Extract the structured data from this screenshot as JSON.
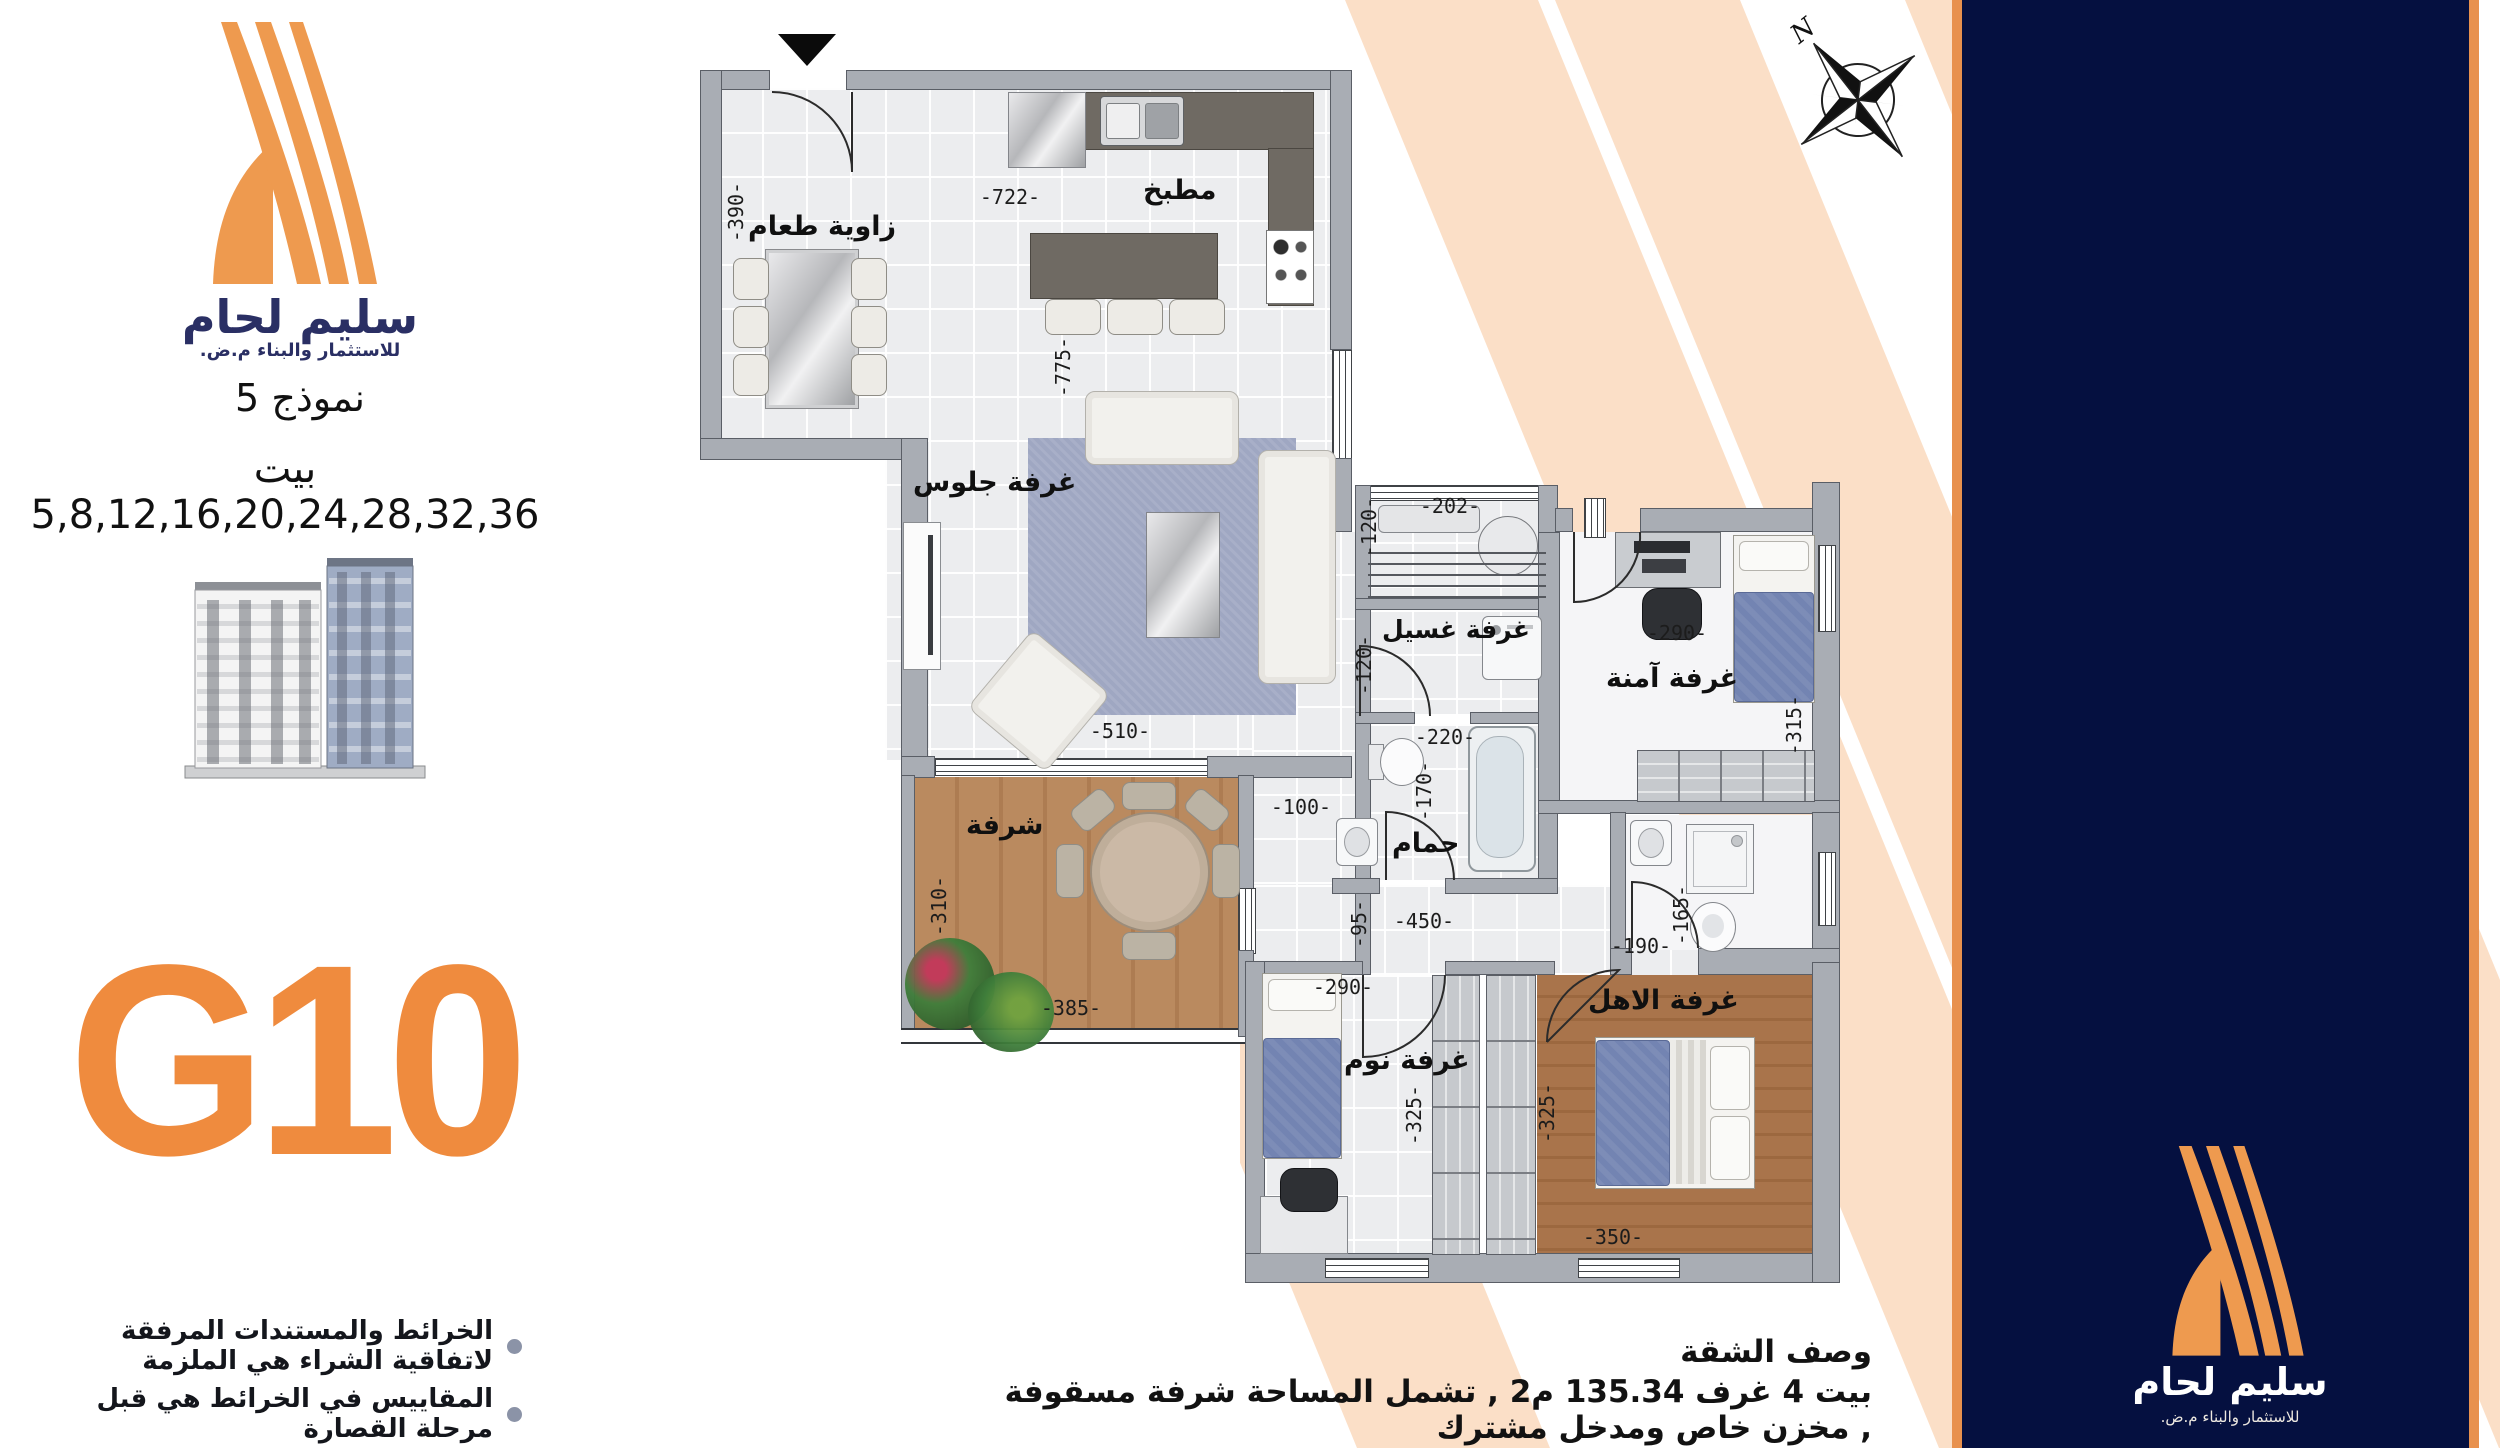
{
  "branding": {
    "title": "سليم لحام",
    "subtitle": "للاستثمار والبناء م.ض.",
    "model": "نموذج 5",
    "houses": "بيت 5,8,12,16,20,24,28,32,36",
    "unit": "G10"
  },
  "compass": {
    "north": "N"
  },
  "rooms": {
    "kitchen": "مطبخ",
    "dining": "زاوية طعام",
    "living": "غرفة جلوس",
    "balcony": "شرفة",
    "laundry": "غرفة غسيل",
    "bath": "حمام",
    "safe": "غرفة آمنة",
    "bedroom": "غرفة نوم",
    "master": "غرفة الاهل"
  },
  "dims": {
    "d390": "-390-",
    "d722": "-722-",
    "d775": "-775-",
    "d510": "-510-",
    "d100": "-100-",
    "d310": "-310-",
    "d385": "-385-",
    "d202": "-202-",
    "d120a": "-120-",
    "d120b": "-120-",
    "d220": "-220-",
    "d170": "-170-",
    "d290a": "-290-",
    "d315": "-315-",
    "d95": "-95-",
    "d450": "-450-",
    "d165": "-165-",
    "d190": "-190-",
    "d290b": "-290-",
    "d325a": "-325-",
    "d325b": "-325-",
    "d350": "-350-"
  },
  "notes": {
    "n1": "الخرائط والمستندات المرفقة لاتفاقية الشراء هي الملزمة",
    "n2": "المقاييس في الخرائط هي قبل مرحلة القصارة"
  },
  "description": {
    "heading": "وصف الشقة",
    "body": "بيت 4 غرف 135.34 م2 , تشمل المساحة شرفة مسقوفة , مخزن خاص ومدخل مشترك"
  },
  "colors": {
    "navy": "#051040",
    "orange_strip": "#E8914E",
    "logo_orange": "#EE9A4F",
    "unit_orange": "#EF8B3E",
    "peach_stripe": "#FBDFC7"
  }
}
